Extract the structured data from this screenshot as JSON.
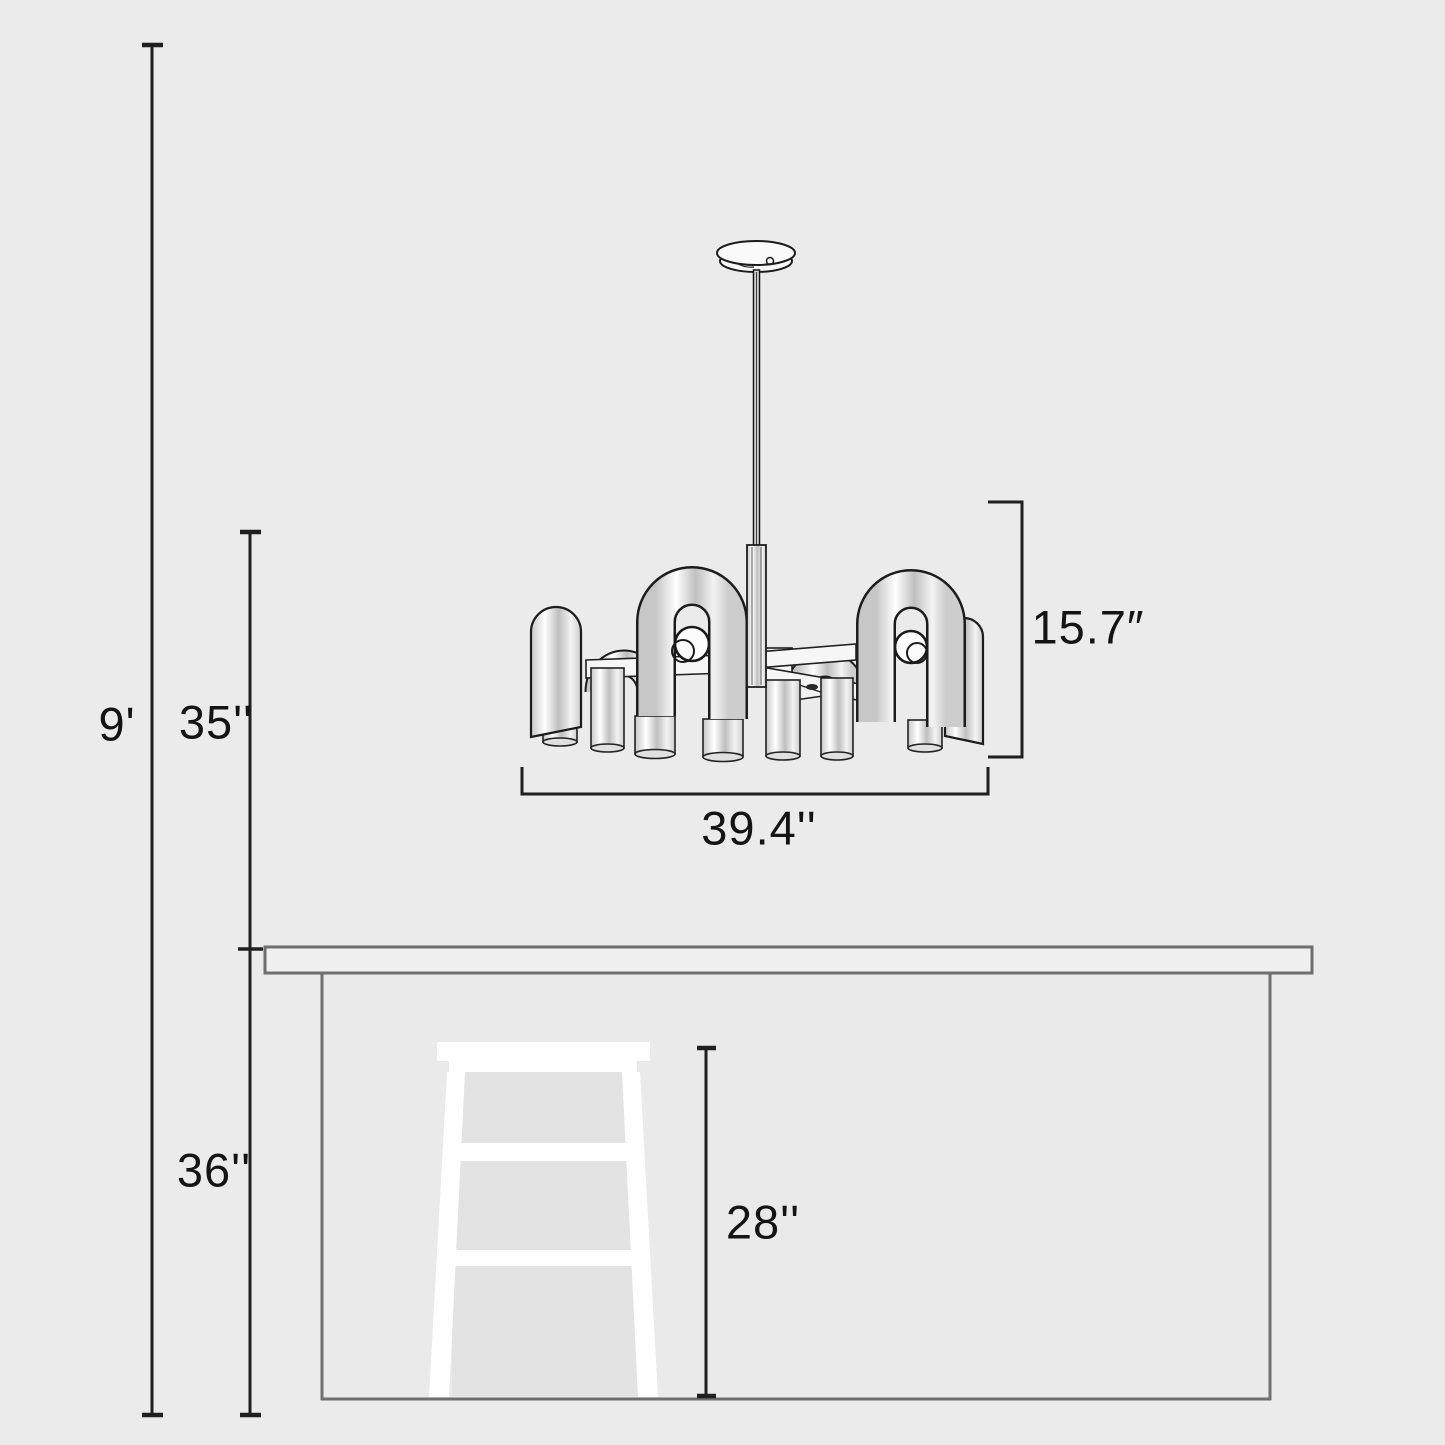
{
  "diagram": {
    "type": "product-dimension-diagram",
    "subject": "chandelier-over-table-with-stool",
    "colors": {
      "background": "#ebebeb",
      "dimension_line": "#1f1f1f",
      "label_text": "#141414",
      "furniture_outline": "#6f6f6f",
      "tabletop_fill": "#f0f0f0",
      "table_fill": "#eaeaea",
      "stool_fill": "#ffffff",
      "fixture_outline": "#1c1c1c",
      "fixture_metal_light": "#ffffff",
      "fixture_metal_dark": "#c0c0c0"
    },
    "labels": {
      "room_height": "9'",
      "hanging_drop": "35''",
      "fixture_height": "15.7″",
      "fixture_width": "39.4''",
      "table_height": "36''",
      "stool_height": "28''"
    }
  }
}
